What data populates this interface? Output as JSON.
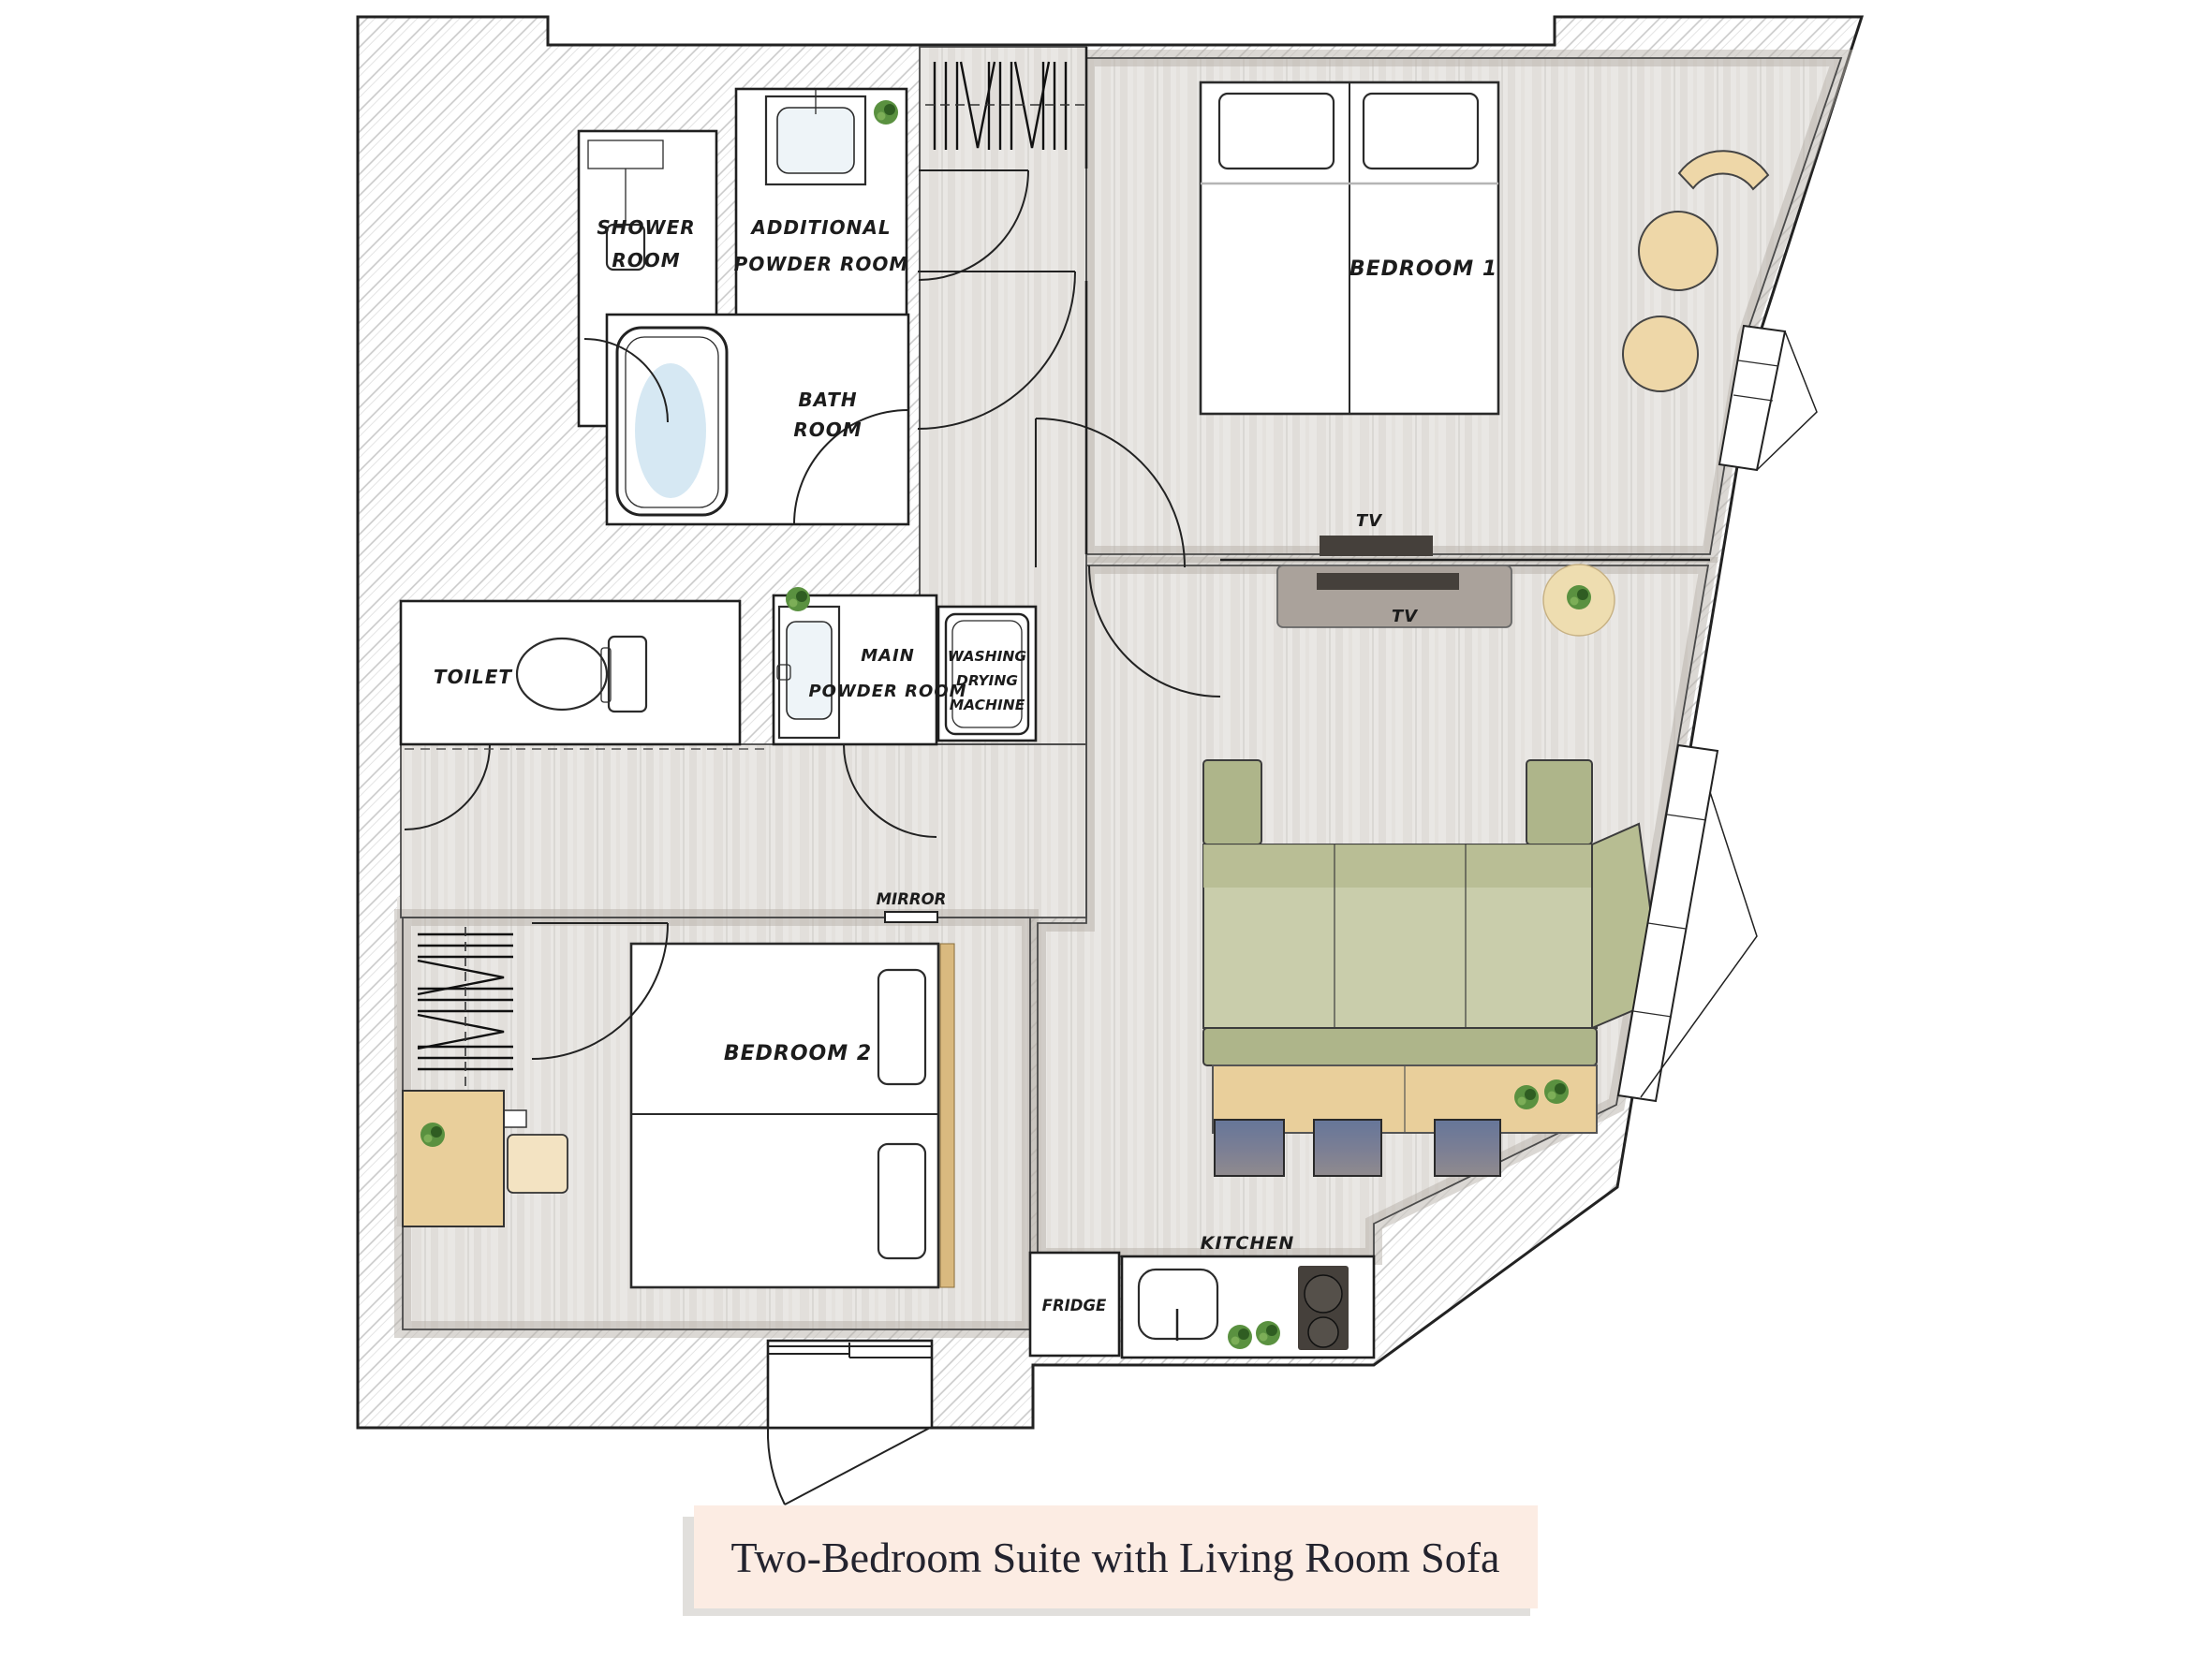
{
  "caption": {
    "text": "Two-Bedroom Suite with Living Room Sofa"
  },
  "rooms": {
    "shower": {
      "lines": [
        "SHOWER",
        "ROOM"
      ]
    },
    "additional_powder": {
      "lines": [
        "ADDITIONAL",
        "POWDER ROOM"
      ]
    },
    "bath": {
      "lines": [
        "BATH",
        "ROOM"
      ]
    },
    "toilet": {
      "label": "TOILET"
    },
    "main_powder": {
      "lines": [
        "MAIN",
        "POWDER ROOM"
      ]
    },
    "washing": {
      "lines": [
        "WASHING",
        "DRYING",
        "MACHINE"
      ]
    },
    "bedroom1": {
      "label": "BEDROOM 1"
    },
    "bedroom2": {
      "label": "BEDROOM 2"
    },
    "kitchen": {
      "label": "KITCHEN"
    },
    "fridge": {
      "label": "FRIDGE"
    }
  },
  "fixtures": {
    "tv_bedroom": "TV",
    "tv_living": "TV",
    "mirror": "MIRROR"
  },
  "colors": {
    "caption_bg": "#fcece3",
    "sofa_green": "#b7bd92",
    "sofa_seat": "#c9cdab",
    "counter_tan": "#e9cf9b",
    "headboard_tan": "#d9b97f",
    "floor_gray": "#e9e7e4",
    "wall_shadow": "#b8b1aa",
    "stool_blue": "#6b7a98",
    "plant_green": "#5a9140",
    "water_blue": "#cfe4f1",
    "appliance_dark": "#45403b",
    "rug_beige": "#eeddb0"
  }
}
